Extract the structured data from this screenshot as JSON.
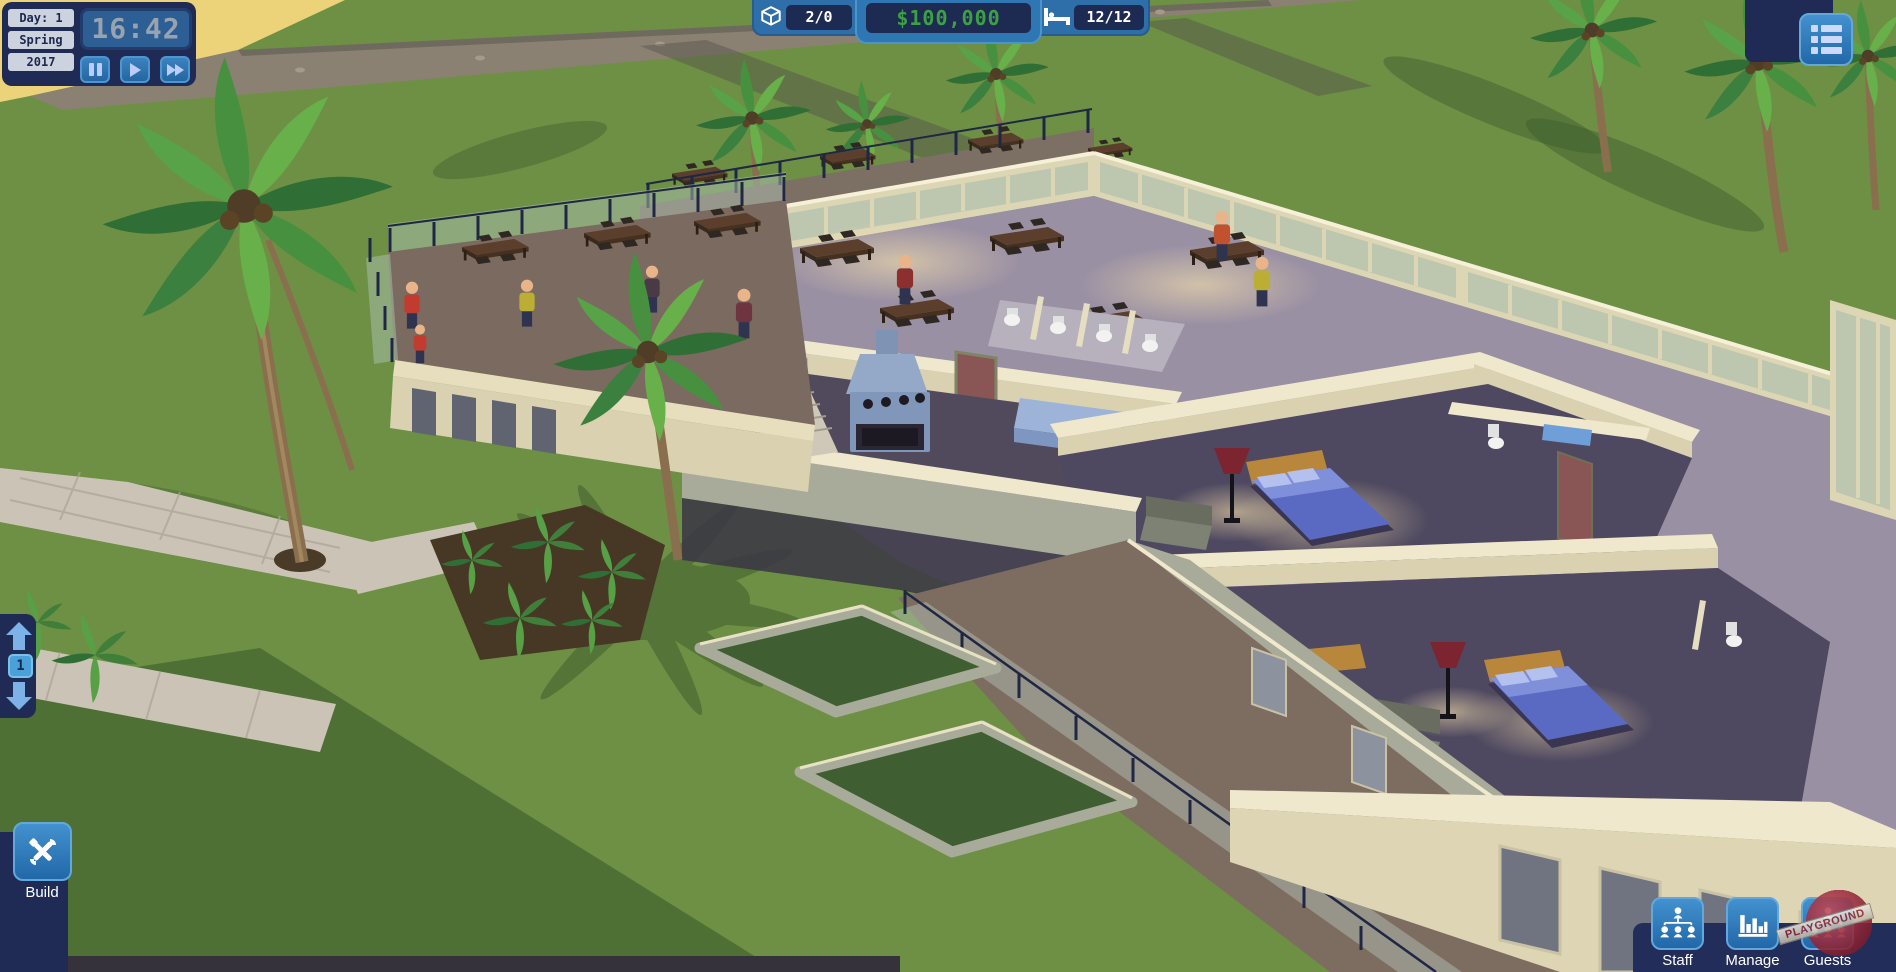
{
  "hud": {
    "date_panel": {
      "day_label": "Day: 1",
      "season": "Spring",
      "year": "2017",
      "time": "16:42"
    },
    "playback": {
      "buttons": [
        {
          "name": "pause"
        },
        {
          "name": "play"
        },
        {
          "name": "fast-forward"
        }
      ]
    },
    "resources": {
      "objects": {
        "icon": "cube-icon",
        "value": "2/0"
      },
      "money": {
        "value": "$100,000"
      },
      "beds": {
        "icon": "bed-icon",
        "value": "12/12"
      }
    },
    "menu_button": {
      "icon": "list-icon"
    },
    "floor_selector": {
      "up_icon": "arrow-up-icon",
      "current_floor": "1",
      "down_icon": "arrow-down-icon"
    },
    "build_button": {
      "label": "Build",
      "icon": "tools-icon"
    },
    "bottom_bar": {
      "buttons": [
        {
          "label": "Staff",
          "icon": "org-chart-icon"
        },
        {
          "label": "Manage",
          "icon": "bar-chart-icon"
        },
        {
          "label": "Guests",
          "icon": "org-chart-icon"
        }
      ]
    },
    "watermark": "PLAYGROUND"
  },
  "colors": {
    "panel_navy": "#1f2a55",
    "button_blue": "#2a73b2",
    "icon_light_blue": "#bcd0f8",
    "money_green": "#3da044",
    "time_grey": "#99a2af",
    "value_white": "#ffffff",
    "grass_green": "#6d9044",
    "sand_yellow": "#ecd37a",
    "wall_cream": "#efe8cd",
    "bedroom_floor": "#4e4860",
    "bed_blue": "#5a6ac2"
  }
}
